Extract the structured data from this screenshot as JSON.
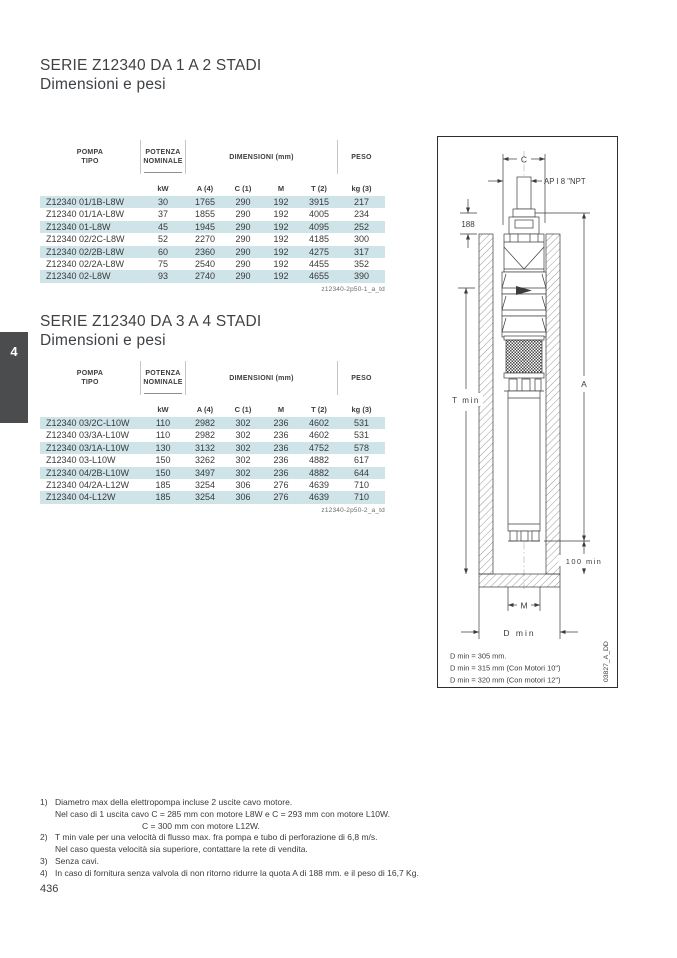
{
  "page_number": "436",
  "side_tab": "4",
  "sections": [
    {
      "title": "SERIE Z12340 DA 1 A 2 STADI",
      "subtitle": "Dimensioni e pesi",
      "table_id": "z12340-2p50-1_a_td",
      "table": {
        "headers": {
          "pompa1": "POMPA",
          "pompa2": "TIPO",
          "potenza1": "POTENZA",
          "potenza2": "NOMINALE",
          "dimensioni": "DIMENSIONI (mm)",
          "peso": "PESO",
          "units": [
            "kW",
            "A (4)",
            "C (1)",
            "M",
            "T (2)",
            "kg (3)"
          ]
        },
        "rows": [
          {
            "type": "Z12340 01/1B-L8W",
            "kw": "30",
            "a": "1765",
            "c": "290",
            "m": "192",
            "t": "3915",
            "kg": "217"
          },
          {
            "type": "Z12340 01/1A-L8W",
            "kw": "37",
            "a": "1855",
            "c": "290",
            "m": "192",
            "t": "4005",
            "kg": "234"
          },
          {
            "type": "Z12340 01-L8W",
            "kw": "45",
            "a": "1945",
            "c": "290",
            "m": "192",
            "t": "4095",
            "kg": "252"
          },
          {
            "type": "Z12340 02/2C-L8W",
            "kw": "52",
            "a": "2270",
            "c": "290",
            "m": "192",
            "t": "4185",
            "kg": "300"
          },
          {
            "type": "Z12340 02/2B-L8W",
            "kw": "60",
            "a": "2360",
            "c": "290",
            "m": "192",
            "t": "4275",
            "kg": "317"
          },
          {
            "type": "Z12340 02/2A-L8W",
            "kw": "75",
            "a": "2540",
            "c": "290",
            "m": "192",
            "t": "4455",
            "kg": "352"
          },
          {
            "type": "Z12340 02-L8W",
            "kw": "93",
            "a": "2740",
            "c": "290",
            "m": "192",
            "t": "4655",
            "kg": "390"
          }
        ]
      }
    },
    {
      "title": "SERIE Z12340 DA 3 A 4 STADI",
      "subtitle": "Dimensioni e pesi",
      "table_id": "z12340-2p50-2_a_td",
      "table": {
        "headers": {
          "pompa1": "POMPA",
          "pompa2": "TIPO",
          "potenza1": "POTENZA",
          "potenza2": "NOMINALE",
          "dimensioni": "DIMENSIONI (mm)",
          "peso": "PESO",
          "units": [
            "kW",
            "A (4)",
            "C (1)",
            "M",
            "T (2)",
            "kg (3)"
          ]
        },
        "rows": [
          {
            "type": "Z12340 03/2C-L10W",
            "kw": "110",
            "a": "2982",
            "c": "302",
            "m": "236",
            "t": "4602",
            "kg": "531"
          },
          {
            "type": "Z12340 03/3A-L10W",
            "kw": "110",
            "a": "2982",
            "c": "302",
            "m": "236",
            "t": "4602",
            "kg": "531"
          },
          {
            "type": "Z12340 03/1A-L10W",
            "kw": "130",
            "a": "3132",
            "c": "302",
            "m": "236",
            "t": "4752",
            "kg": "578"
          },
          {
            "type": "Z12340 03-L10W",
            "kw": "150",
            "a": "3262",
            "c": "302",
            "m": "236",
            "t": "4882",
            "kg": "617"
          },
          {
            "type": "Z12340 04/2B-L10W",
            "kw": "150",
            "a": "3497",
            "c": "302",
            "m": "236",
            "t": "4882",
            "kg": "644"
          },
          {
            "type": "Z12340 04/2A-L12W",
            "kw": "185",
            "a": "3254",
            "c": "306",
            "m": "276",
            "t": "4639",
            "kg": "710"
          },
          {
            "type": "Z12340 04-L12W",
            "kw": "185",
            "a": "3254",
            "c": "306",
            "m": "276",
            "t": "4639",
            "kg": "710"
          }
        ]
      }
    }
  ],
  "diagram": {
    "labels": {
      "c": "C",
      "npt": "AP I 8 \"NPT",
      "q188": "188",
      "t_min": "T min",
      "a": "A",
      "min100": "100 min",
      "m": "M",
      "d_min": "D min",
      "drawing_id": "03827_A_DD"
    },
    "notes": [
      "D min = 305 mm.",
      "D min = 315 mm (Con Motori 10\")",
      "D min = 320 mm (Con motori 12\")"
    ]
  },
  "footnotes": [
    {
      "num": "1)",
      "lines": [
        "Diametro max della elettropompa incluse 2 uscite cavo motore.",
        "Nel caso di 1 uscita cavo C = 285 mm con motore L8W e C = 293 mm con motore L10W.",
        "C = 300 mm con motore L12W."
      ]
    },
    {
      "num": "2)",
      "lines": [
        "T min vale per una velocità di flusso max. fra pompa e tubo di perforazione di 6,8 m/s.",
        "Nel caso questa velocità sia superiore, contattare la rete di vendita."
      ]
    },
    {
      "num": "3)",
      "lines": [
        "Senza cavi."
      ]
    },
    {
      "num": "4)",
      "lines": [
        "In caso di fornitura senza valvola di non ritorno ridurre la quota A di 188 mm. e il peso di 16,7 Kg."
      ]
    }
  ]
}
